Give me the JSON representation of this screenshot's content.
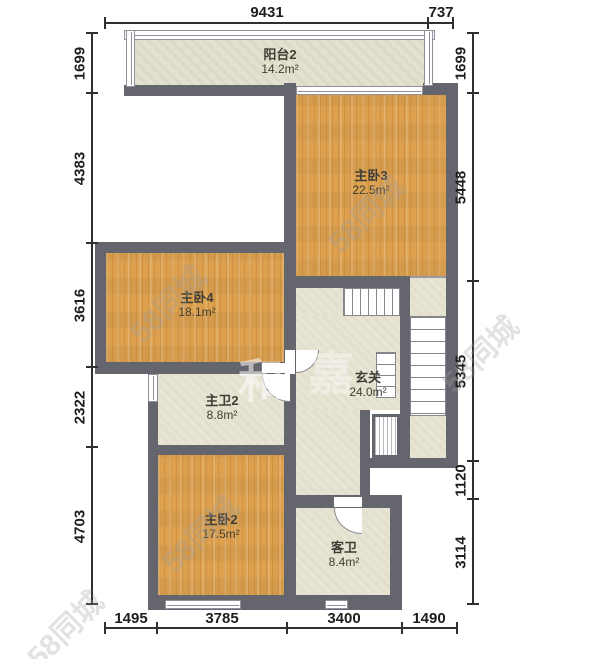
{
  "rooms": [
    {
      "name": "阳台2",
      "area": "14.2m²"
    },
    {
      "name": "主卧3",
      "area": "22.5m²"
    },
    {
      "name": "主卧4",
      "area": "18.1m²"
    },
    {
      "name": "主卫2",
      "area": "8.8m²"
    },
    {
      "name": "玄关",
      "area": "24.0m²"
    },
    {
      "name": "主卧2",
      "area": "17.5m²"
    },
    {
      "name": "客卫",
      "area": "8.4m²"
    }
  ],
  "dimensions": {
    "top": [
      "9431",
      "737"
    ],
    "left": [
      "1699",
      "4383",
      "3616",
      "2322",
      "4703"
    ],
    "right": [
      "1699",
      "5448",
      "5345",
      "1120",
      "3114"
    ],
    "bottom": [
      "1495",
      "3785",
      "3400",
      "1490"
    ]
  },
  "watermarks": {
    "diagonal": "58同城",
    "char1": "和",
    "char2": "嘉"
  },
  "colors": {
    "wall": "#65656d",
    "wood": "#dca04e",
    "tile": "#e7e4d3",
    "dim_text": "#1e1e1e"
  }
}
